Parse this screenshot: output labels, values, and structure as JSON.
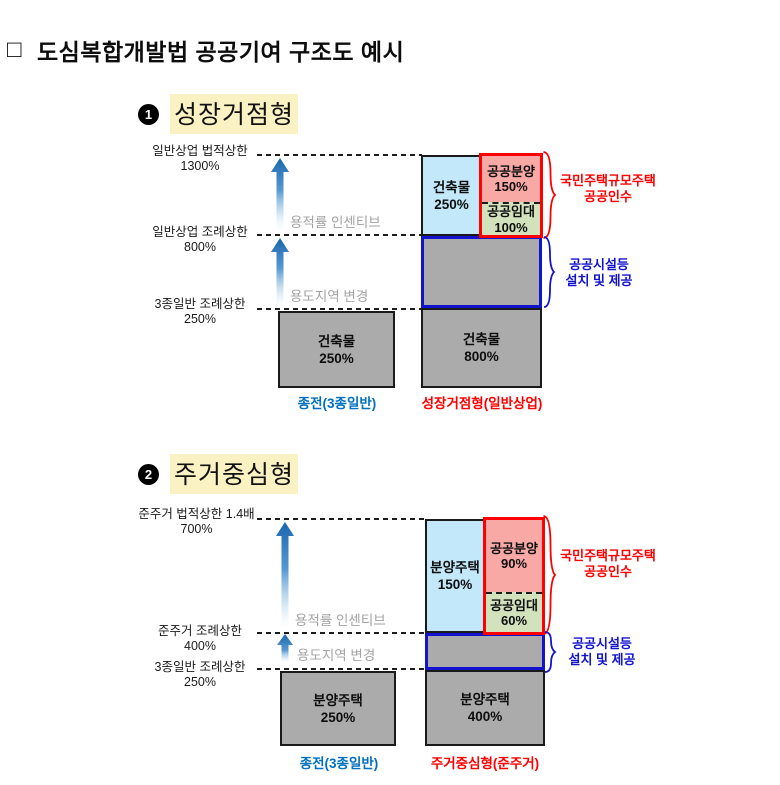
{
  "title": {
    "bullet": "□",
    "text": "도심복합개발법 공공기여 구조도 예시"
  },
  "colors": {
    "light_blue_fill": "#C3E8F9",
    "pink_fill": "#F8A8A5",
    "green_fill": "#D2E2BC",
    "gray_fill": "#ABABAB",
    "red_accent": "#FE0000",
    "blue_border": "#1313CE",
    "caption_blue": "#0070C0",
    "incentive_gray": "#A3A3A3",
    "highlight_yellow": "#FBF2C3",
    "arrow_blue": "#2E74B5"
  },
  "d1": {
    "num": "1",
    "heading": "성장거점형",
    "axis": [
      {
        "name": "일반상업 법적상한",
        "value": "1300%"
      },
      {
        "name": "일반상업 조례상한",
        "value": "800%"
      },
      {
        "name": "3종일반 조례상한",
        "value": "250%"
      }
    ],
    "incentive_label": "용적률 인센티브",
    "zone_change_label": "용도지역 변경",
    "left_box": {
      "name": "건축물",
      "pct": "250%"
    },
    "left_caption": "종전(3종일반)",
    "bar_top": {
      "name": "건축물",
      "pct": "250%"
    },
    "public_sale": {
      "name": "공공분양",
      "pct": "150%"
    },
    "public_rent": {
      "name": "공공임대",
      "pct": "100%"
    },
    "bar_bottom": {
      "name": "건축물",
      "pct": "800%"
    },
    "right_caption": "성장거점형(일반상업)",
    "red_note": {
      "line1": "국민주택규모주택",
      "line2": "공공인수"
    },
    "blue_note": {
      "line1": "공공시설등",
      "line2": "설치 및 제공"
    }
  },
  "d2": {
    "num": "2",
    "heading": "주거중심형",
    "axis": [
      {
        "name": "준주거 법적상한 1.4배",
        "value": "700%"
      },
      {
        "name": "준주거 조례상한",
        "value": "400%"
      },
      {
        "name": "3종일반 조례상한",
        "value": "250%"
      }
    ],
    "incentive_label": "용적률 인센티브",
    "zone_change_label": "용도지역 변경",
    "left_box": {
      "name": "분양주택",
      "pct": "250%"
    },
    "left_caption": "종전(3종일반)",
    "bar_top": {
      "name": "분양주택",
      "pct": "150%"
    },
    "public_sale": {
      "name": "공공분양",
      "pct": "90%"
    },
    "public_rent": {
      "name": "공공임대",
      "pct": "60%"
    },
    "bar_bottom": {
      "name": "분양주택",
      "pct": "400%"
    },
    "right_caption": "주거중심형(준주거)",
    "red_note": {
      "line1": "국민주택규모주택",
      "line2": "공공인수"
    },
    "blue_note": {
      "line1": "공공시설등",
      "line2": "설치 및 제공"
    }
  }
}
